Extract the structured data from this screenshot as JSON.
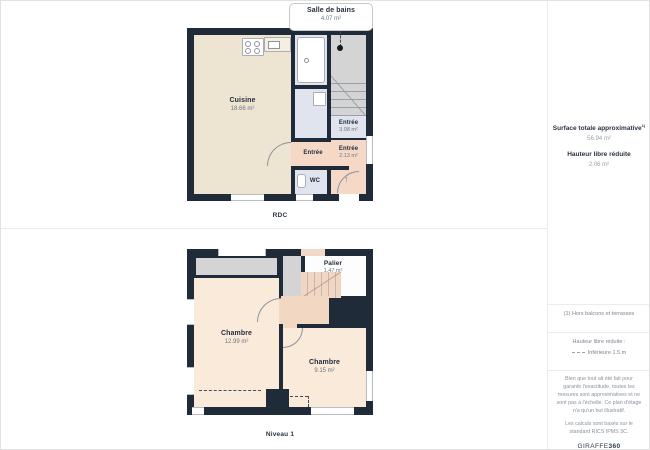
{
  "plans": {
    "rdc": {
      "caption": "RDC",
      "callout": {
        "name": "Salle de bains",
        "area": "4.07 m²"
      },
      "cuisine": {
        "name": "Cuisine",
        "area": "18.66 m²"
      },
      "entree_a": {
        "name": "Entrée",
        "area": "3.08 m²"
      },
      "entree_b": {
        "name": "Entrée",
        "area": "2.13 m²"
      },
      "entree_c": {
        "name": "Entrée"
      },
      "wc": {
        "name": "WC"
      },
      "entry_arrow": "↑"
    },
    "niveau1": {
      "caption": "Niveau 1",
      "chambre_a": {
        "name": "Chambre",
        "area": "12.99 m²"
      },
      "chambre_b": {
        "name": "Chambre",
        "area": "9.15 m²"
      },
      "palier": {
        "name": "Palier",
        "area": "1.47 m²"
      }
    }
  },
  "sidebar": {
    "surface_title": "Surface totale approximative",
    "surface_sup": "1)",
    "surface_value": "56.94 m²",
    "height_title": "Hauteur libre réduite",
    "height_value": "2.06 m²",
    "footnote": "(1) Hors balcons et terrasses",
    "legend_title": "Hauteur libre réduite :",
    "legend_label": "Inférieure 1.5 m",
    "disclaimer": "Bien que tout ait été fait pour garantir l'exactitude, toutes les mesures sont approximatives et ne sont pas à l'échelle. Ce plan d'étage n'a qu'un but illustratif.",
    "standard": "Les calculs sont basés sur le standard RICS IPMS 3C.",
    "logo_prefix": "GIRAFFE",
    "logo_suffix": "360"
  },
  "colors": {
    "wall": "#202b39",
    "kitchen": "#ede5d1",
    "bedroom": "#faeada",
    "entry": "#f5d9c6",
    "bath": "#e0e4ee",
    "stairs_gray": "#d4d4d4",
    "text_dark": "#232e3c",
    "text_gray": "#8b929c"
  }
}
